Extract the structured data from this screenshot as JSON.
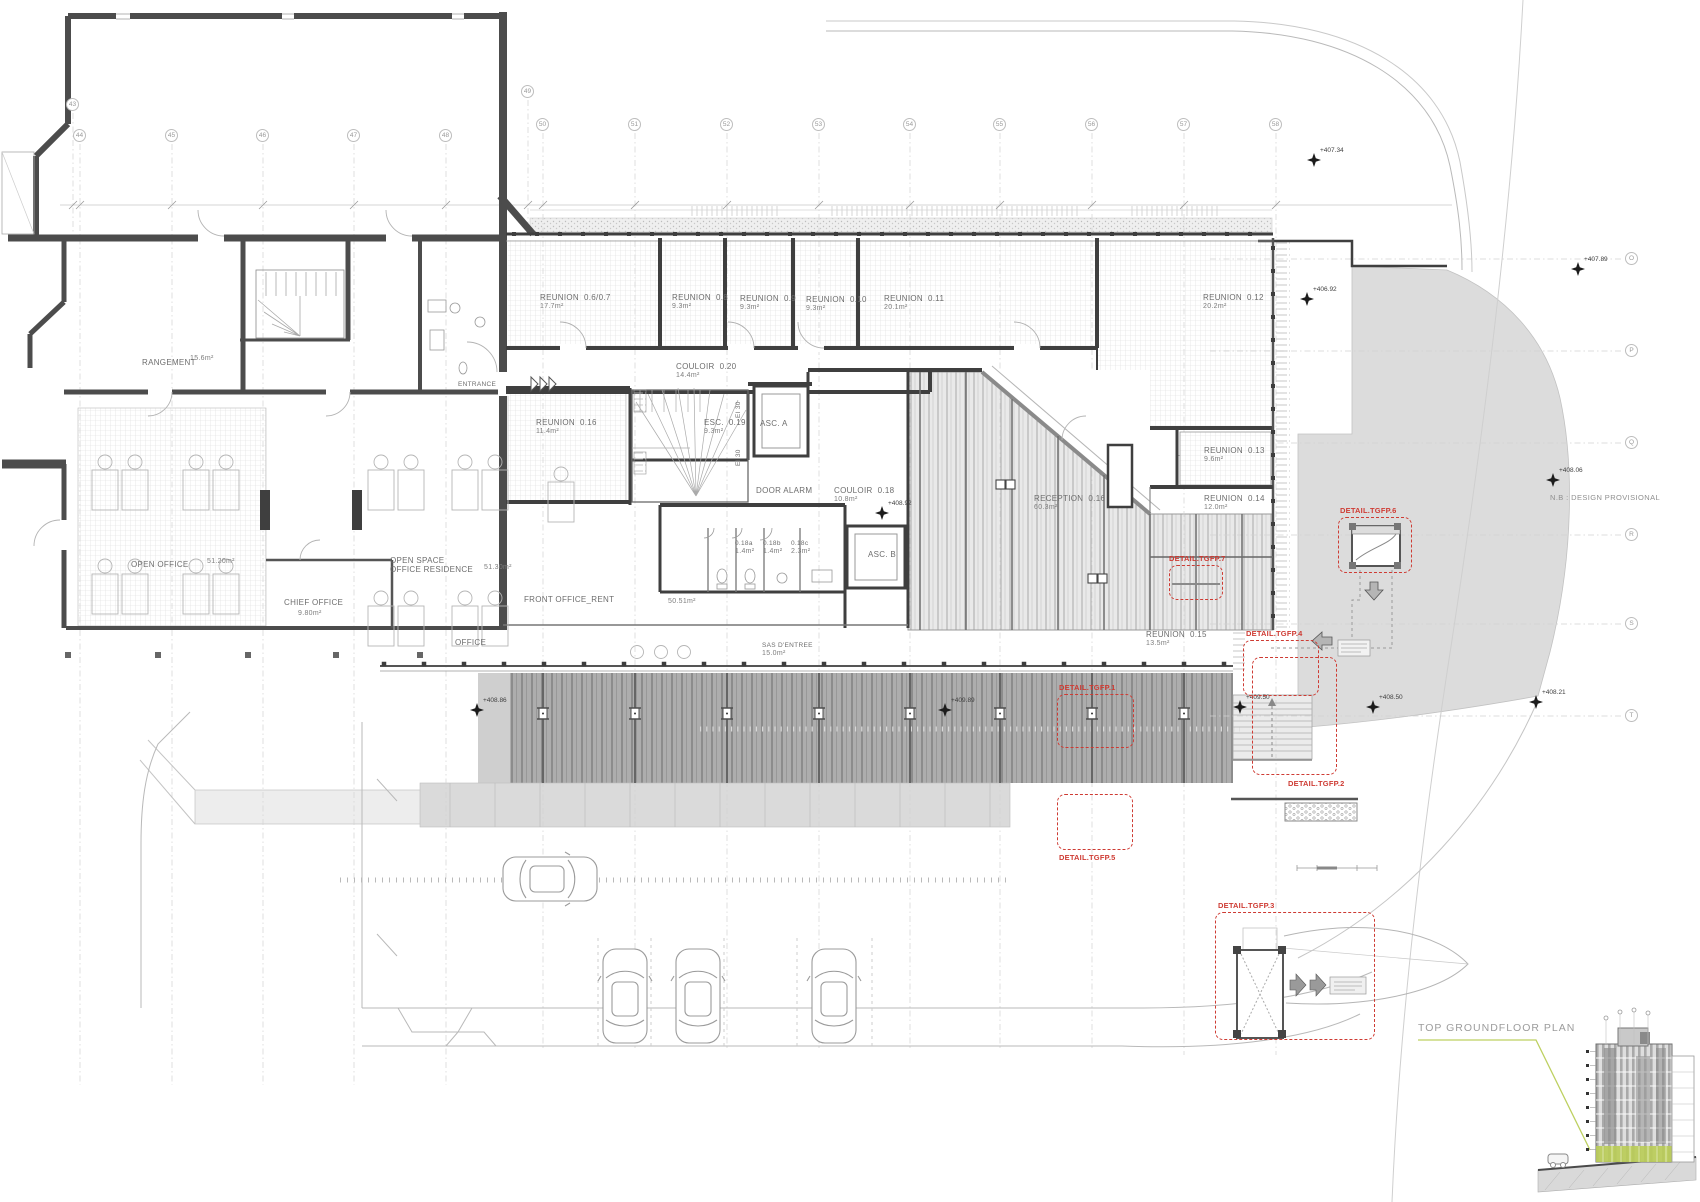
{
  "annotations": {
    "provisional_note": "N.B : DESIGN PROVISIONAL",
    "plan_title": "TOP GROUNDFLOOR PLAN"
  },
  "grid": {
    "columns": [
      {
        "n": "43",
        "x": 73,
        "y": 105,
        "drop": 238
      },
      {
        "n": "44",
        "x": 80,
        "y": 136,
        "drop": 1085
      },
      {
        "n": "45",
        "x": 172,
        "y": 136,
        "drop": 1085
      },
      {
        "n": "46",
        "x": 263,
        "y": 136,
        "drop": 1085
      },
      {
        "n": "47",
        "x": 354,
        "y": 136,
        "drop": 1085
      },
      {
        "n": "48",
        "x": 446,
        "y": 136,
        "drop": 1085
      },
      {
        "n": "49",
        "x": 528,
        "y": 92,
        "drop": 235
      },
      {
        "n": "50",
        "x": 543,
        "y": 125,
        "drop": 1050
      },
      {
        "n": "51",
        "x": 635,
        "y": 125,
        "drop": 1050
      },
      {
        "n": "52",
        "x": 727,
        "y": 125,
        "drop": 1050
      },
      {
        "n": "53",
        "x": 819,
        "y": 125,
        "drop": 1050
      },
      {
        "n": "54",
        "x": 910,
        "y": 125,
        "drop": 1050
      },
      {
        "n": "55",
        "x": 1000,
        "y": 125,
        "drop": 1050
      },
      {
        "n": "56",
        "x": 1092,
        "y": 125,
        "drop": 1050
      },
      {
        "n": "57",
        "x": 1184,
        "y": 125,
        "drop": 1055
      },
      {
        "n": "58",
        "x": 1276,
        "y": 125,
        "drop": 1055
      }
    ],
    "rows": [
      {
        "n": "O",
        "x": 1632,
        "y": 259
      },
      {
        "n": "P",
        "x": 1632,
        "y": 351
      },
      {
        "n": "Q",
        "x": 1632,
        "y": 443
      },
      {
        "n": "R",
        "x": 1632,
        "y": 535
      },
      {
        "n": "S",
        "x": 1632,
        "y": 624
      },
      {
        "n": "T",
        "x": 1632,
        "y": 716
      }
    ]
  },
  "rooms": [
    {
      "name": "RANGEMENT",
      "area": "15.6m²",
      "x": 142,
      "y": 358,
      "adx": 48,
      "ady": -4
    },
    {
      "name": "ENTRANCE",
      "x": 458,
      "y": 379,
      "small": true
    },
    {
      "name": "REUNION  0.6/0.7",
      "area": "17.7m²",
      "x": 540,
      "y": 293
    },
    {
      "name": "REUNION  0.8",
      "area": "9.3m²",
      "x": 672,
      "y": 293
    },
    {
      "name": "REUNION  0.9",
      "area": "9.3m²",
      "x": 740,
      "y": 294
    },
    {
      "name": "REUNION  0.10",
      "area": "9.3m²",
      "x": 806,
      "y": 295
    },
    {
      "name": "REUNION  0.11",
      "area": "20.1m²",
      "x": 884,
      "y": 294
    },
    {
      "name": "REUNION  0.12",
      "area": "20.2m²",
      "x": 1203,
      "y": 293
    },
    {
      "name": "COULOIR  0.20",
      "area": "14.4m²",
      "x": 676,
      "y": 362
    },
    {
      "name": "REUNION  0.16",
      "area": "11.4m²",
      "x": 536,
      "y": 418
    },
    {
      "name": "ESC.  0.19",
      "area": "9.3m²",
      "x": 704,
      "y": 418
    },
    {
      "name": "ASC. A",
      "x": 760,
      "y": 419
    },
    {
      "name": "EI 30",
      "x": 733,
      "y": 418,
      "rot": -90,
      "small": true
    },
    {
      "name": "EI 30",
      "x": 733,
      "y": 466,
      "rot": -90,
      "small": true
    },
    {
      "name": "DOOR ALARM",
      "x": 756,
      "y": 486
    },
    {
      "name": "COULOIR  0.18",
      "area": "10.8m²",
      "x": 834,
      "y": 486
    },
    {
      "name": "0.18a",
      "area": "1.4m²",
      "x": 735,
      "y": 538,
      "small": true
    },
    {
      "name": "0.18b",
      "area": "1.4m²",
      "x": 763,
      "y": 538,
      "small": true
    },
    {
      "name": "0.18c",
      "area": "2.3m²",
      "x": 791,
      "y": 538,
      "small": true
    },
    {
      "name": "ASC. B",
      "x": 868,
      "y": 550
    },
    {
      "name": "RECEPTION  0.16",
      "area": "60.3m²",
      "x": 1034,
      "y": 494
    },
    {
      "name": "REUNION  0.13",
      "area": "9.6m²",
      "x": 1204,
      "y": 446
    },
    {
      "name": "REUNION  0.14",
      "area": "12.0m²",
      "x": 1204,
      "y": 494
    },
    {
      "name": "REUNION  0.15",
      "area": "13.5m²",
      "x": 1146,
      "y": 630
    },
    {
      "name": "OPEN OFFICE",
      "area": "51.20m²",
      "x": 131,
      "y": 560,
      "adx": 76,
      "ady": -3
    },
    {
      "name": "CHIEF OFFICE",
      "area": "9.80m²",
      "x": 284,
      "y": 598,
      "adx": 14,
      "ady": 11
    },
    {
      "name": "OPEN SPACE\nOFFICE RESIDENCE",
      "area": "51.30m²",
      "x": 390,
      "y": 556,
      "adx": 94,
      "ady": 7
    },
    {
      "name": "OFFICE",
      "x": 455,
      "y": 638
    },
    {
      "name": "FRONT OFFICE_RENT",
      "area": "50.51m²",
      "x": 524,
      "y": 595,
      "adx": 144,
      "ady": 2
    },
    {
      "name": "SAS D'ENTREE",
      "area": "15.0m²",
      "x": 762,
      "y": 640,
      "small": true
    }
  ],
  "levels": [
    {
      "v": "+407.34",
      "x": 1314,
      "y": 160
    },
    {
      "v": "+407.89",
      "x": 1578,
      "y": 269
    },
    {
      "v": "+406.92",
      "x": 1307,
      "y": 299
    },
    {
      "v": "+408.06",
      "x": 1553,
      "y": 480
    },
    {
      "v": "+408.21",
      "x": 1536,
      "y": 702
    },
    {
      "v": "+408.50",
      "x": 1373,
      "y": 707
    },
    {
      "v": "+409.50",
      "x": 1240,
      "y": 707
    },
    {
      "v": "+409.89",
      "x": 945,
      "y": 710
    },
    {
      "v": "+408.86",
      "x": 477,
      "y": 710
    },
    {
      "v": "+408.92",
      "x": 882,
      "y": 513
    }
  ],
  "details": [
    {
      "label": "DETAIL.TGFP.1",
      "lx": 1059,
      "ly": 683,
      "bx": 1057,
      "by": 694,
      "bw": 77,
      "bh": 54
    },
    {
      "label": "DETAIL.TGFP.2",
      "lx": 1288,
      "ly": 779,
      "bx": 1252,
      "by": 657,
      "bw": 85,
      "bh": 118
    },
    {
      "label": "DETAIL.TGFP.3",
      "lx": 1218,
      "ly": 901,
      "bx": 1215,
      "by": 912,
      "bw": 160,
      "bh": 128
    },
    {
      "label": "DETAIL.TGFP.4",
      "lx": 1246,
      "ly": 629,
      "bx": 1243,
      "by": 640,
      "bw": 76,
      "bh": 56
    },
    {
      "label": "DETAIL.TGFP.5",
      "lx": 1059,
      "ly": 853,
      "bx": 1057,
      "by": 794,
      "bw": 76,
      "bh": 56
    },
    {
      "label": "DETAIL.TGFP.6",
      "lx": 1340,
      "ly": 506,
      "bx": 1338,
      "by": 517,
      "bw": 74,
      "bh": 56
    },
    {
      "label": "DETAIL.TGFP.7",
      "lx": 1169,
      "ly": 554,
      "bx": 1169,
      "by": 565,
      "bw": 54,
      "bh": 35
    }
  ]
}
